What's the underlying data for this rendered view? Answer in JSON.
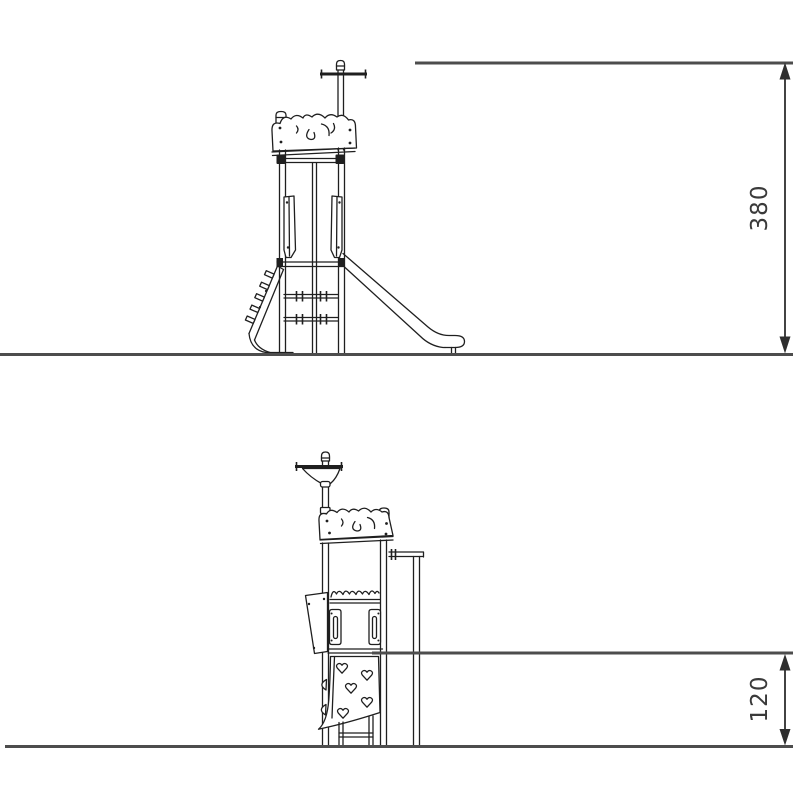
{
  "drawing": {
    "background": "#ffffff",
    "structure_line_color": "#1f1f1f",
    "ground_line_color": "#4d4d4d",
    "dimension_line_color": "#2e2e2e",
    "dimension_text_color": "#3a3a3a",
    "views": {
      "top": {
        "dimension_label": "380"
      },
      "bottom": {
        "dimension_label": "120"
      }
    }
  }
}
